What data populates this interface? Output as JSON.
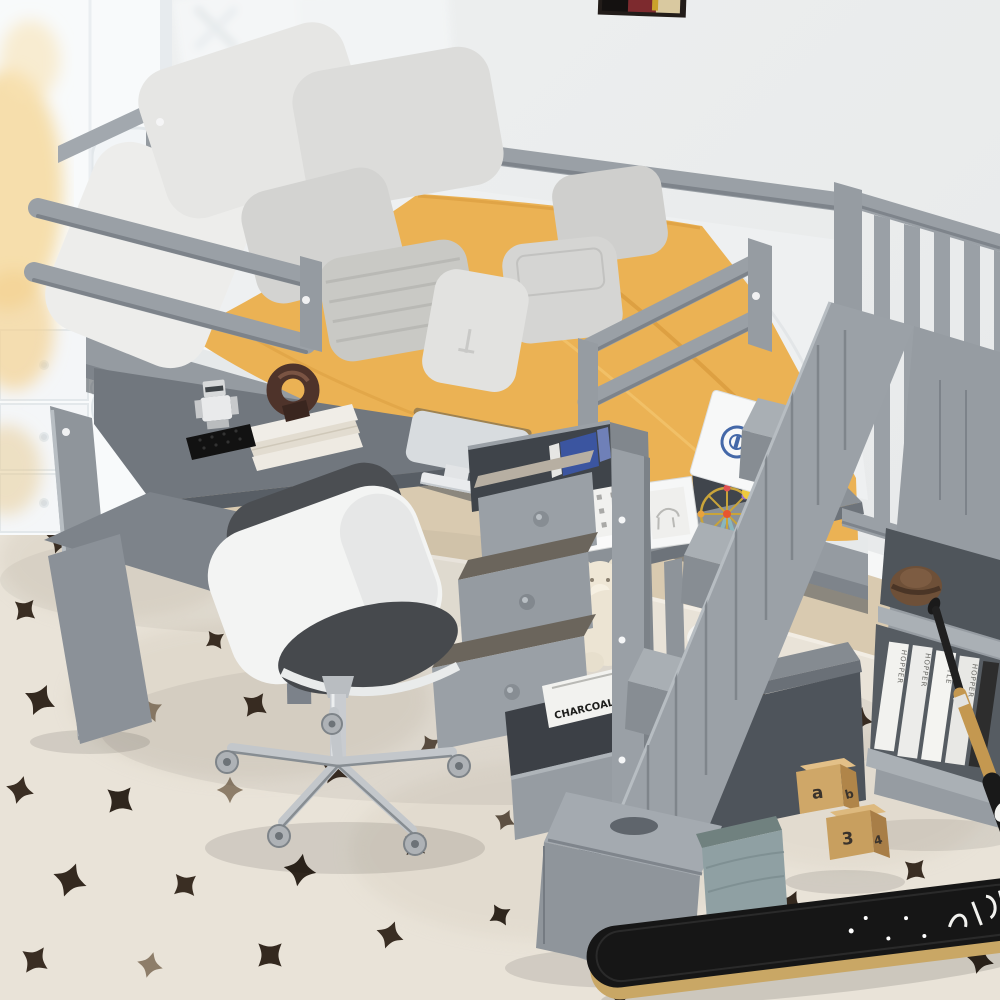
{
  "meta": {
    "title": "Gray twin loft bed with desk, drawers and storage staircase",
    "description": "Product photograph of a gray wooden twin-size loft bed. Under the bed: L-shaped desk with monitor, book stack with ring sculpture and toy robot, white office chair, chest with open cascading drawers, open shelves holding picture frames, a ferris-wheel building toy, a box with a blue emblem, teddy bear and whale plush toys. Right side: storage staircase with railing, shelf nook with a felt hat and books, leaning baseball bat. Foreground: cream area rug with dark spots, skateboard, alphabet blocks and a fabric basket. Background: white wall with partial art frame and a white wardrobe."
  },
  "palette": {
    "wall": "#ecedee",
    "bed_frame_gray": "#9aa0a6",
    "bed_frame_dark": "#70767d",
    "mattress_white": "#eef0f1",
    "blanket_yellow": "#ebb254",
    "pillow_gray": "#d6d6d4",
    "rug_cream": "#e9e3d8",
    "rug_spot_brown": "#3a2e23",
    "chair_shell_white": "#f3f4f3",
    "chair_cushion_gray": "#46494d",
    "chrome": "#c6cacd",
    "skateboard_black": "#161616",
    "bat_wood": "#c79a52",
    "toy_block_wood": "#cfa768",
    "basket_teal": "#8fa0a3",
    "emblem_blue": "#4468a8",
    "sculpture_brown": "#4e332a",
    "baseboard_white": "#f6f7f7",
    "wood_floor": "#d9cab0"
  },
  "texts": {
    "drawer_book_title": "CHARCOAL",
    "book_spines": {
      "s1": "HOPPER",
      "s2": "HOPPER",
      "s3": "STYLE",
      "s4": "HOPPER"
    },
    "bat_brand": "DGW",
    "blocks": {
      "a": "a",
      "b": "b",
      "n3": "3",
      "n4": "4"
    }
  },
  "scene_objects": [
    "loft-bed-frame",
    "guard-rails",
    "stair-railing",
    "storage-staircase",
    "mattress",
    "yellow-comforter",
    "gray-pillows",
    "l-shaped-desk",
    "desktop-monitor",
    "book-stack",
    "ring-sculpture",
    "toy-robot",
    "office-chair",
    "drawer-chest",
    "open-drawer-book",
    "picture-frames",
    "ferris-wheel-toy",
    "emblem-box",
    "teddy-bear-plush",
    "whale-plush",
    "shelf-books",
    "felt-hat",
    "baseball-bat",
    "skateboard",
    "alphabet-blocks",
    "storage-basket",
    "area-rug",
    "white-wardrobe",
    "wall-art"
  ]
}
